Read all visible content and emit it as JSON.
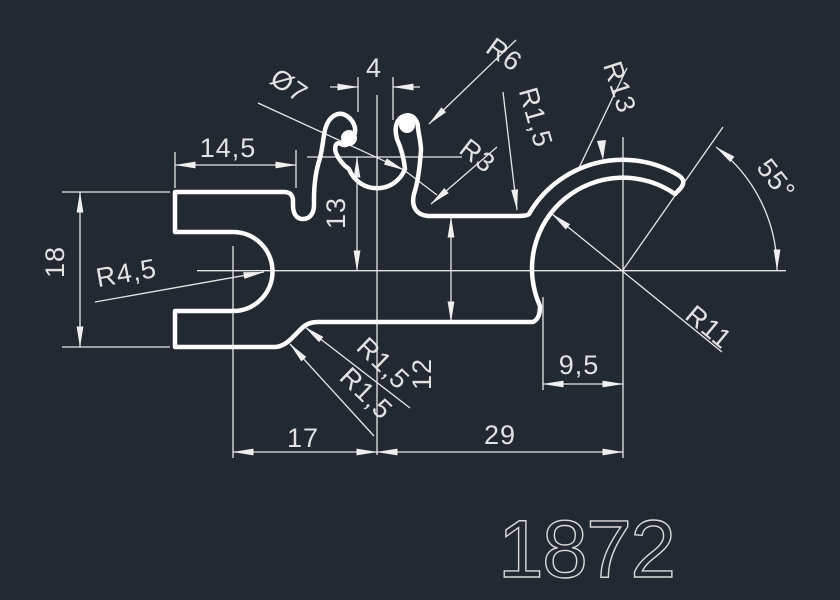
{
  "drawing": {
    "part_number": "1872",
    "colors": {
      "background": "#232931",
      "profile_line": "#fdfdfd",
      "dimension_line": "#e6e6e6",
      "text": "#e2e2e2"
    },
    "dims": {
      "top_width": "14,5",
      "left_height": "18",
      "slot_radius": "R4,5",
      "socket_diameter": "Ø7",
      "socket_gap": "4",
      "finger_curl_radius": "R6",
      "ledge_fillet_radius": "R1,5",
      "bend_radius": "R3",
      "hook_outer_radius": "R13",
      "hook_end_angle": "55°",
      "hook_inner_radius": "R11",
      "chamfer_fillet_1": "R1,5",
      "chamfer_fillet_2": "R1,5",
      "socket_center_height": "13",
      "step_height": "12",
      "hook_offset": "9,5",
      "mid_width": "17",
      "right_width": "29"
    }
  }
}
